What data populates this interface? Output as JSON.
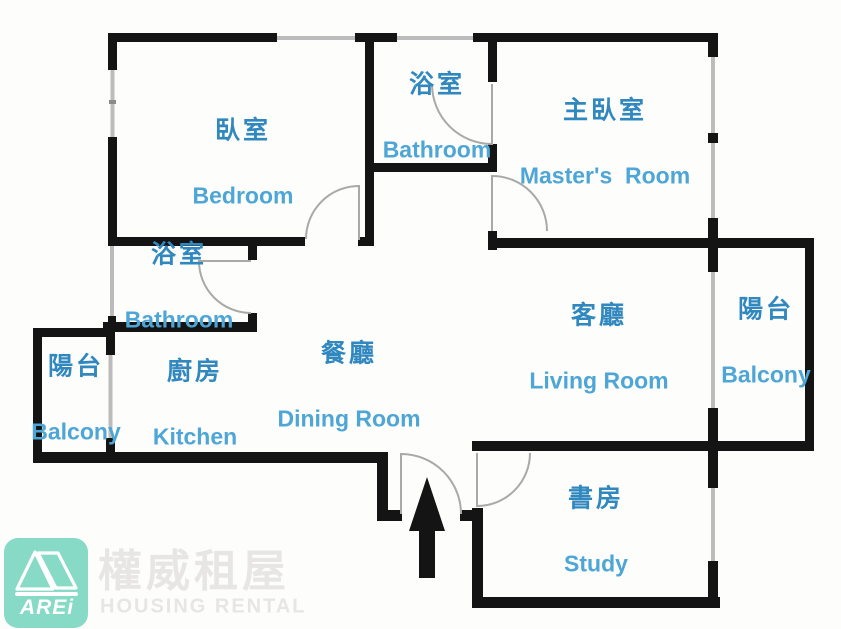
{
  "colors": {
    "wall_color": "#141414",
    "window_color": "#bcbcbc",
    "door_color": "#a9a9a9",
    "label_zh_color": "#3188bf",
    "label_en_color": "#4da6d6",
    "logo_color": "#87dac6",
    "watermark_color": "#e8e6e2"
  },
  "rooms": [
    {
      "id": "bedroom",
      "zh": "臥室",
      "en": "Bedroom"
    },
    {
      "id": "bathroom-top",
      "zh": "浴室",
      "en": "Bathroom"
    },
    {
      "id": "master-room",
      "zh": "主臥室",
      "en": "Master's  Room"
    },
    {
      "id": "bathroom-left",
      "zh": "浴室",
      "en": "Bathroom"
    },
    {
      "id": "balcony-left",
      "zh": "陽台",
      "en": "Balcony"
    },
    {
      "id": "kitchen",
      "zh": "廚房",
      "en": "Kitchen"
    },
    {
      "id": "dining-room",
      "zh": "餐廳",
      "en": "Dining Room"
    },
    {
      "id": "living-room",
      "zh": "客廳",
      "en": "Living Room"
    },
    {
      "id": "balcony-right",
      "zh": "陽台",
      "en": "Balcony"
    },
    {
      "id": "study",
      "zh": "書房",
      "en": "Study"
    }
  ],
  "logo": {
    "brand": "AREi",
    "zh": "權威租屋",
    "en": "HOUSING RENTAL"
  }
}
